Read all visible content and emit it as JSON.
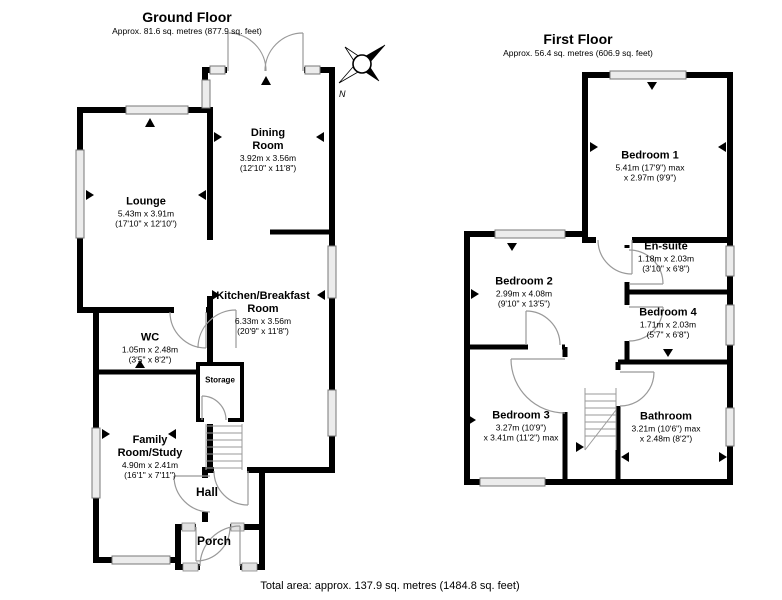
{
  "ground_floor": {
    "title": "Ground Floor",
    "area": "Approx. 81.6 sq. metres (877.9 sq. feet)",
    "rooms": {
      "dining": {
        "name": "Dining Room",
        "dims1": "3.92m x 3.56m",
        "dims2": "(12'10\" x 11'8\")"
      },
      "lounge": {
        "name": "Lounge",
        "dims1": "5.43m x 3.91m",
        "dims2": "(17'10\" x 12'10\")"
      },
      "kitchen": {
        "name": "Kitchen/Breakfast Room",
        "dims1": "6.33m x 3.56m",
        "dims2": "(20'9\" x 11'8\")"
      },
      "wc": {
        "name": "WC",
        "dims1": "1.05m x 2.48m",
        "dims2": "(3'5\" x 8'2\")"
      },
      "family": {
        "name": "Family Room/Study",
        "dims1": "4.90m x 2.41m",
        "dims2": "(16'1\" x 7'11\")"
      },
      "storage": {
        "name": "Storage"
      },
      "hall": {
        "name": "Hall"
      },
      "porch": {
        "name": "Porch"
      }
    }
  },
  "first_floor": {
    "title": "First Floor",
    "area": "Approx. 56.4 sq. metres (606.9 sq. feet)",
    "rooms": {
      "bedroom1": {
        "name": "Bedroom 1",
        "dims1": "5.41m (17'9\") max",
        "dims2": "x 2.97m (9'9\")"
      },
      "ensuite": {
        "name": "En-suite",
        "dims1": "1.18m x 2.03m",
        "dims2": "(3'10\" x 6'8\")"
      },
      "bedroom2": {
        "name": "Bedroom 2",
        "dims1": "2.99m x 4.08m",
        "dims2": "(9'10\" x 13'5\")"
      },
      "bedroom4": {
        "name": "Bedroom 4",
        "dims1": "1.71m x 2.03m",
        "dims2": "(5'7\" x 6'8\")"
      },
      "bedroom3": {
        "name": "Bedroom 3",
        "dims1": "3.27m (10'9\")",
        "dims2": "x 3.41m (11'2\") max"
      },
      "bathroom": {
        "name": "Bathroom",
        "dims1": "3.21m (10'6\") max",
        "dims2": "x 2.48m (8'2\")"
      }
    }
  },
  "footer": {
    "total": "Total area: approx. 137.9 sq. metres (1484.8 sq. feet)"
  },
  "compass": {
    "north_label": "N"
  },
  "colors": {
    "wall": "#000000",
    "window_fill": "#ececec",
    "door_arc": "#999999"
  }
}
